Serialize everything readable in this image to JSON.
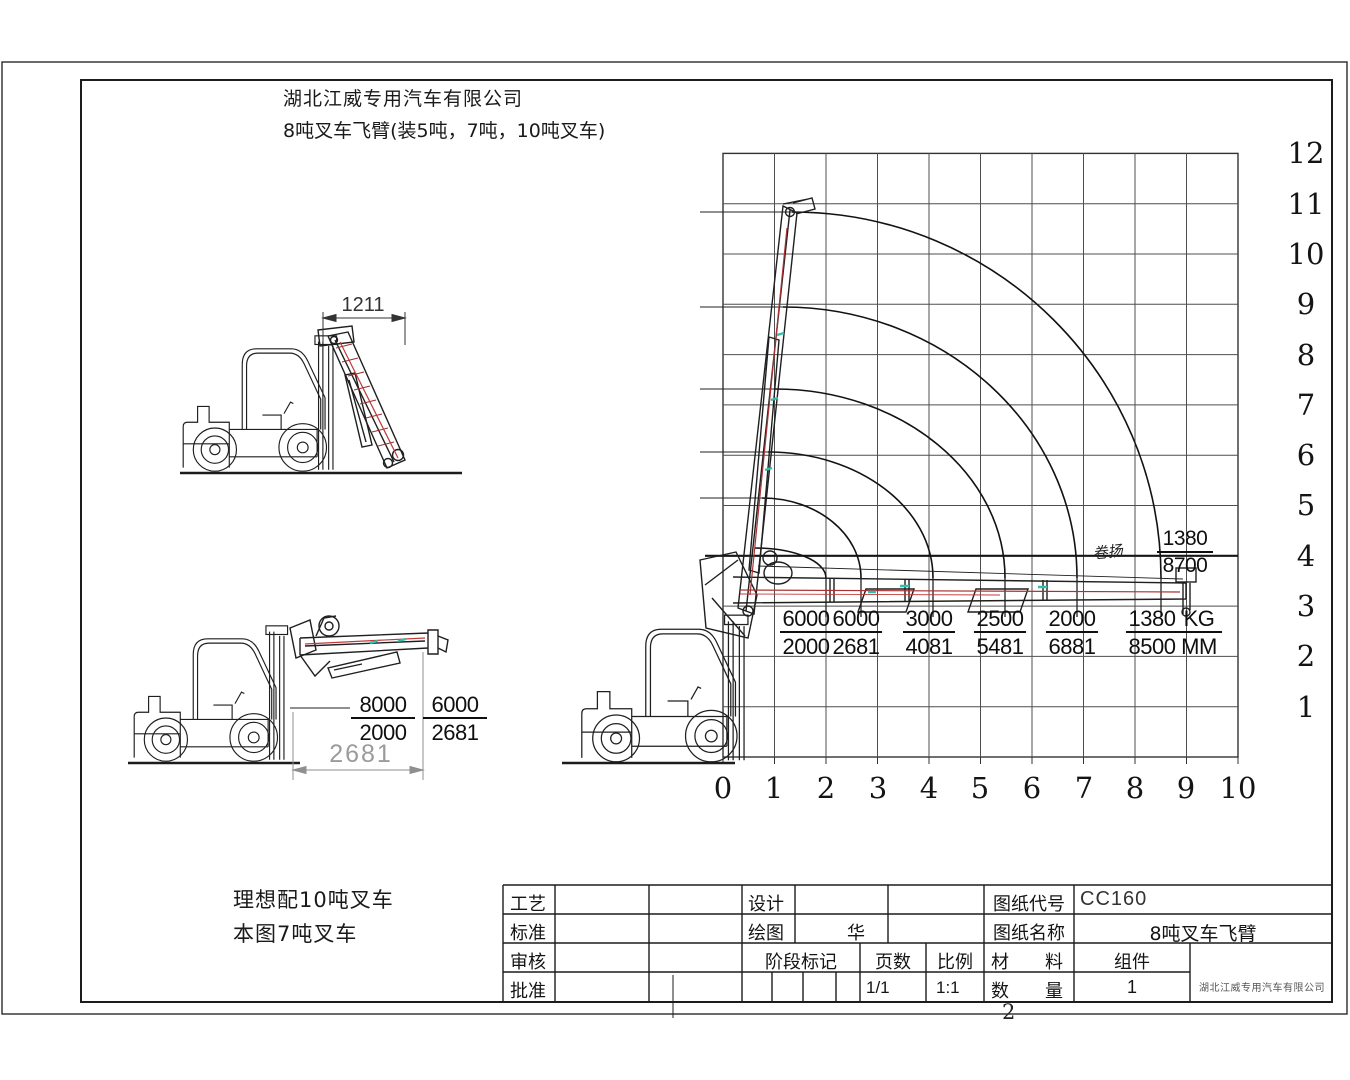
{
  "header": {
    "company": "湖北江威专用汽车有限公司",
    "title": "8吨叉车飞臂(装5吨，7吨，10吨叉车)"
  },
  "notes": {
    "ideal": "理想配10吨叉车",
    "current": "本图7吨叉车"
  },
  "side_views": {
    "folded_width_mm": "1211",
    "min_reach_mm": "2681",
    "ratings": [
      {
        "load_kg": "8000",
        "reach_mm": "2000"
      },
      {
        "load_kg": "6000",
        "reach_mm": "2681"
      }
    ]
  },
  "chart_data": {
    "type": "line",
    "description": "Forklift jib crane capacity curves: lifting load (KG) versus reach (MM); axes in metres (reach 0-10 m, height 0-12 m)",
    "x_axis": {
      "ticks": [
        "0",
        "1",
        "2",
        "3",
        "4",
        "5",
        "6",
        "7",
        "8",
        "9",
        "10"
      ],
      "range": [
        0,
        10
      ],
      "unit": "m"
    },
    "y_axis": {
      "ticks": [
        "1",
        "2",
        "3",
        "4",
        "5",
        "6",
        "7",
        "8",
        "9",
        "10",
        "11",
        "12"
      ],
      "range": [
        0,
        12
      ],
      "unit": "m"
    },
    "grid": true,
    "units": {
      "load": "KG",
      "reach": "MM"
    },
    "capacity_table": [
      {
        "load_kg": "6000",
        "reach_mm": "2000"
      },
      {
        "load_kg": "6000",
        "reach_mm": "2681"
      },
      {
        "load_kg": "3000",
        "reach_mm": "4081"
      },
      {
        "load_kg": "2500",
        "reach_mm": "5481"
      },
      {
        "load_kg": "2000",
        "reach_mm": "6881"
      },
      {
        "load_kg": "1380",
        "reach_mm": "8500"
      }
    ],
    "winch": {
      "label": "卷扬",
      "load_kg": "1380",
      "reach_mm": "8700"
    },
    "curves": [
      {
        "load_kg": 6000,
        "reach_m": 2.0,
        "tip_height_m": 4.2
      },
      {
        "load_kg": 6000,
        "reach_m": 2.681,
        "tip_height_m": 5.2
      },
      {
        "load_kg": 3000,
        "reach_m": 4.081,
        "tip_height_m": 6.1
      },
      {
        "load_kg": 2500,
        "reach_m": 5.481,
        "tip_height_m": 7.3
      },
      {
        "load_kg": 2000,
        "reach_m": 6.881,
        "tip_height_m": 8.9
      },
      {
        "load_kg": 1380,
        "reach_m": 8.5,
        "tip_height_m": 10.8
      }
    ]
  },
  "title_block": {
    "process_label": "工艺",
    "standard_label": "标准",
    "check_label": "审核",
    "approve_label": "批准",
    "design_label": "设计",
    "draw_label": "绘图",
    "draw_value": "华",
    "stage_label": "阶段标记",
    "pages_label": "页数",
    "pages_value": "1/1",
    "scale_label": "比例",
    "scale_value": "1:1",
    "code_label": "图纸代号",
    "code_value": "CC160",
    "name_label": "图纸名称",
    "name_value": "8吨叉车飞臂",
    "material_label": "材　　料",
    "assembly_label": "组件",
    "quantity_label": "数　　量",
    "quantity_value": "1",
    "company_small": "湖北江威专用汽车有限公司"
  },
  "page_number": "2"
}
